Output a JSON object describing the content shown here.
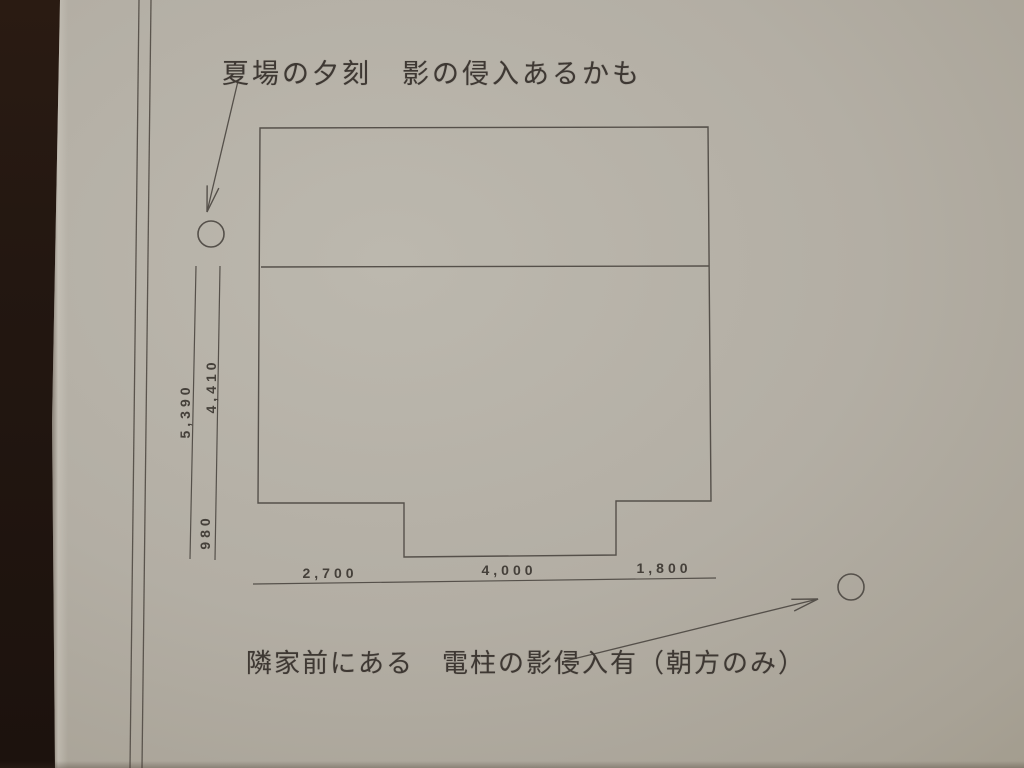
{
  "notes": {
    "top": "夏場の夕刻　影の侵入あるかも",
    "bottom": "隣家前にある　電柱の影侵入有（朝方のみ）"
  },
  "dimensions": {
    "left_total": "5,390",
    "left_upper": "4,410",
    "left_lower": "980",
    "bottom_left": "2,700",
    "bottom_center": "4,000",
    "bottom_right": "1,800"
  },
  "markers": {
    "left_circle": "shadow-source-marker",
    "right_circle": "utility-pole-marker"
  },
  "colors": {
    "paper": "#b3aea4",
    "desk": "#211711",
    "ink_line": "#55504a",
    "ink_text": "#3e3833"
  }
}
